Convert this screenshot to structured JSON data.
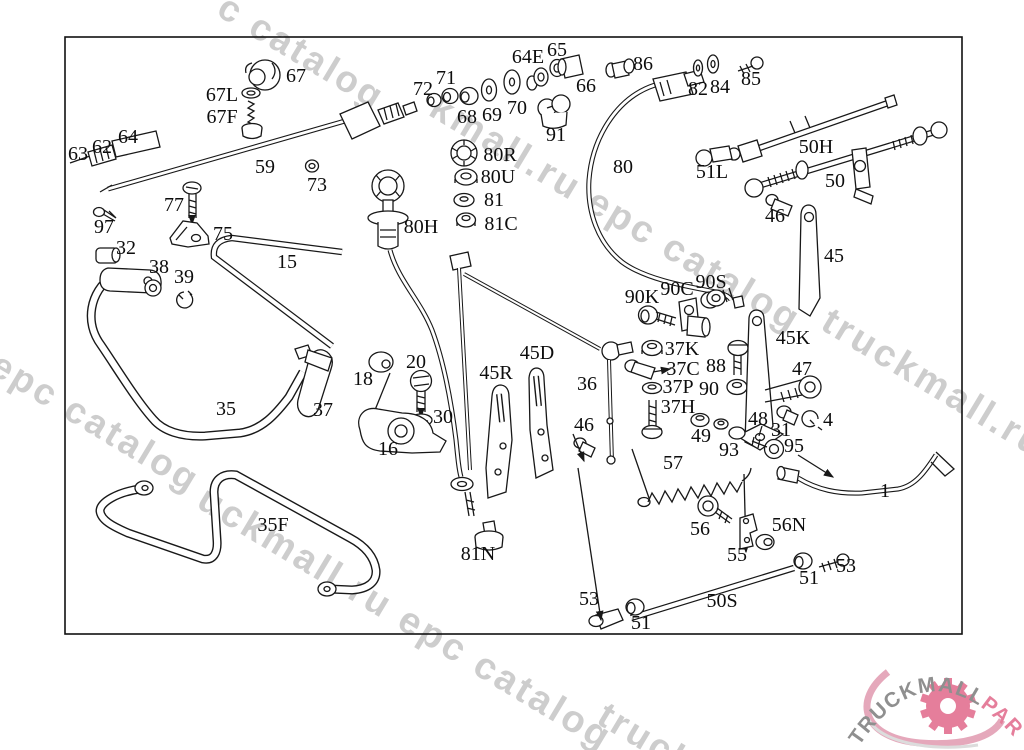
{
  "diagram": {
    "labels": [
      {
        "t": "67",
        "x": 296,
        "y": 76
      },
      {
        "t": "67L",
        "x": 222,
        "y": 95
      },
      {
        "t": "67F",
        "x": 222,
        "y": 117
      },
      {
        "t": "63",
        "x": 78,
        "y": 154
      },
      {
        "t": "62",
        "x": 102,
        "y": 147
      },
      {
        "t": "64",
        "x": 128,
        "y": 137
      },
      {
        "t": "59",
        "x": 265,
        "y": 167
      },
      {
        "t": "73",
        "x": 317,
        "y": 185
      },
      {
        "t": "97",
        "x": 104,
        "y": 227
      },
      {
        "t": "77",
        "x": 174,
        "y": 205
      },
      {
        "t": "75",
        "x": 223,
        "y": 234
      },
      {
        "t": "32",
        "x": 126,
        "y": 248
      },
      {
        "t": "38",
        "x": 159,
        "y": 267
      },
      {
        "t": "39",
        "x": 184,
        "y": 277
      },
      {
        "t": "15",
        "x": 287,
        "y": 262
      },
      {
        "t": "35",
        "x": 226,
        "y": 409
      },
      {
        "t": "37",
        "x": 323,
        "y": 410
      },
      {
        "t": "18",
        "x": 363,
        "y": 379
      },
      {
        "t": "20",
        "x": 416,
        "y": 362
      },
      {
        "t": "30",
        "x": 443,
        "y": 417
      },
      {
        "t": "16",
        "x": 388,
        "y": 449
      },
      {
        "t": "35F",
        "x": 273,
        "y": 525
      },
      {
        "t": "72",
        "x": 423,
        "y": 89
      },
      {
        "t": "71",
        "x": 446,
        "y": 78
      },
      {
        "t": "68",
        "x": 467,
        "y": 117
      },
      {
        "t": "69",
        "x": 492,
        "y": 115
      },
      {
        "t": "70",
        "x": 517,
        "y": 108
      },
      {
        "t": "64E",
        "x": 528,
        "y": 57
      },
      {
        "t": "65",
        "x": 557,
        "y": 50
      },
      {
        "t": "66",
        "x": 586,
        "y": 86
      },
      {
        "t": "91",
        "x": 556,
        "y": 135
      },
      {
        "t": "80R",
        "x": 500,
        "y": 155
      },
      {
        "t": "80U",
        "x": 498,
        "y": 177
      },
      {
        "t": "81",
        "x": 494,
        "y": 200
      },
      {
        "t": "81C",
        "x": 501,
        "y": 224
      },
      {
        "t": "80H",
        "x": 421,
        "y": 227
      },
      {
        "t": "86",
        "x": 643,
        "y": 64
      },
      {
        "t": "82",
        "x": 698,
        "y": 89
      },
      {
        "t": "84",
        "x": 720,
        "y": 87
      },
      {
        "t": "85",
        "x": 751,
        "y": 79
      },
      {
        "t": "80",
        "x": 623,
        "y": 167
      },
      {
        "t": "50H",
        "x": 816,
        "y": 147
      },
      {
        "t": "51L",
        "x": 712,
        "y": 172
      },
      {
        "t": "50",
        "x": 835,
        "y": 181
      },
      {
        "t": "46",
        "x": 775,
        "y": 216
      },
      {
        "t": "45",
        "x": 834,
        "y": 256
      },
      {
        "t": "90K",
        "x": 642,
        "y": 297
      },
      {
        "t": "90C",
        "x": 677,
        "y": 289
      },
      {
        "t": "90S",
        "x": 711,
        "y": 282
      },
      {
        "t": "37K",
        "x": 682,
        "y": 349
      },
      {
        "t": "37C",
        "x": 683,
        "y": 369
      },
      {
        "t": "37P",
        "x": 678,
        "y": 387
      },
      {
        "t": "37H",
        "x": 678,
        "y": 407
      },
      {
        "t": "88",
        "x": 716,
        "y": 366
      },
      {
        "t": "90",
        "x": 709,
        "y": 389
      },
      {
        "t": "45K",
        "x": 793,
        "y": 338
      },
      {
        "t": "47",
        "x": 802,
        "y": 369
      },
      {
        "t": "48",
        "x": 758,
        "y": 419
      },
      {
        "t": "31",
        "x": 781,
        "y": 430
      },
      {
        "t": "4",
        "x": 828,
        "y": 420
      },
      {
        "t": "49",
        "x": 701,
        "y": 436
      },
      {
        "t": "93",
        "x": 729,
        "y": 450
      },
      {
        "t": "95",
        "x": 794,
        "y": 446
      },
      {
        "t": "45D",
        "x": 537,
        "y": 353
      },
      {
        "t": "45R",
        "x": 496,
        "y": 373
      },
      {
        "t": "36",
        "x": 587,
        "y": 384
      },
      {
        "t": "46",
        "x": 584,
        "y": 425
      },
      {
        "t": "57",
        "x": 673,
        "y": 463
      },
      {
        "t": "56",
        "x": 700,
        "y": 529
      },
      {
        "t": "55",
        "x": 737,
        "y": 555
      },
      {
        "t": "56N",
        "x": 789,
        "y": 525
      },
      {
        "t": "81N",
        "x": 478,
        "y": 554
      },
      {
        "t": "53",
        "x": 589,
        "y": 599
      },
      {
        "t": "51",
        "x": 641,
        "y": 623
      },
      {
        "t": "50S",
        "x": 722,
        "y": 601
      },
      {
        "t": "51",
        "x": 809,
        "y": 578
      },
      {
        "t": "53",
        "x": 846,
        "y": 566
      },
      {
        "t": "1",
        "x": 885,
        "y": 491
      }
    ]
  },
  "watermark": {
    "full_text": "truckmall.ru epc catalog",
    "color": "#cdcdcd",
    "items": [
      {
        "t": "c catalog",
        "x": 232,
        "y": -14,
        "s": 37
      },
      {
        "t": "kmall.ru epc catalog",
        "x": 444,
        "y": 86,
        "s": 38
      },
      {
        "t": "l epc catalog",
        "x": -18,
        "y": 330,
        "s": 37
      },
      {
        "t": "uckmall.ru epc catalog",
        "x": 212,
        "y": 478,
        "s": 38
      },
      {
        "t": "truckmall.ru e",
        "x": 836,
        "y": 300,
        "s": 38
      },
      {
        "t": "truck",
        "x": 612,
        "y": 694,
        "s": 37
      }
    ]
  },
  "logo": {
    "text_gray": "TRUCKMALL",
    "text_pink": "PARTS",
    "gray": "#8f8f8f",
    "pink": "#e57e9b"
  }
}
